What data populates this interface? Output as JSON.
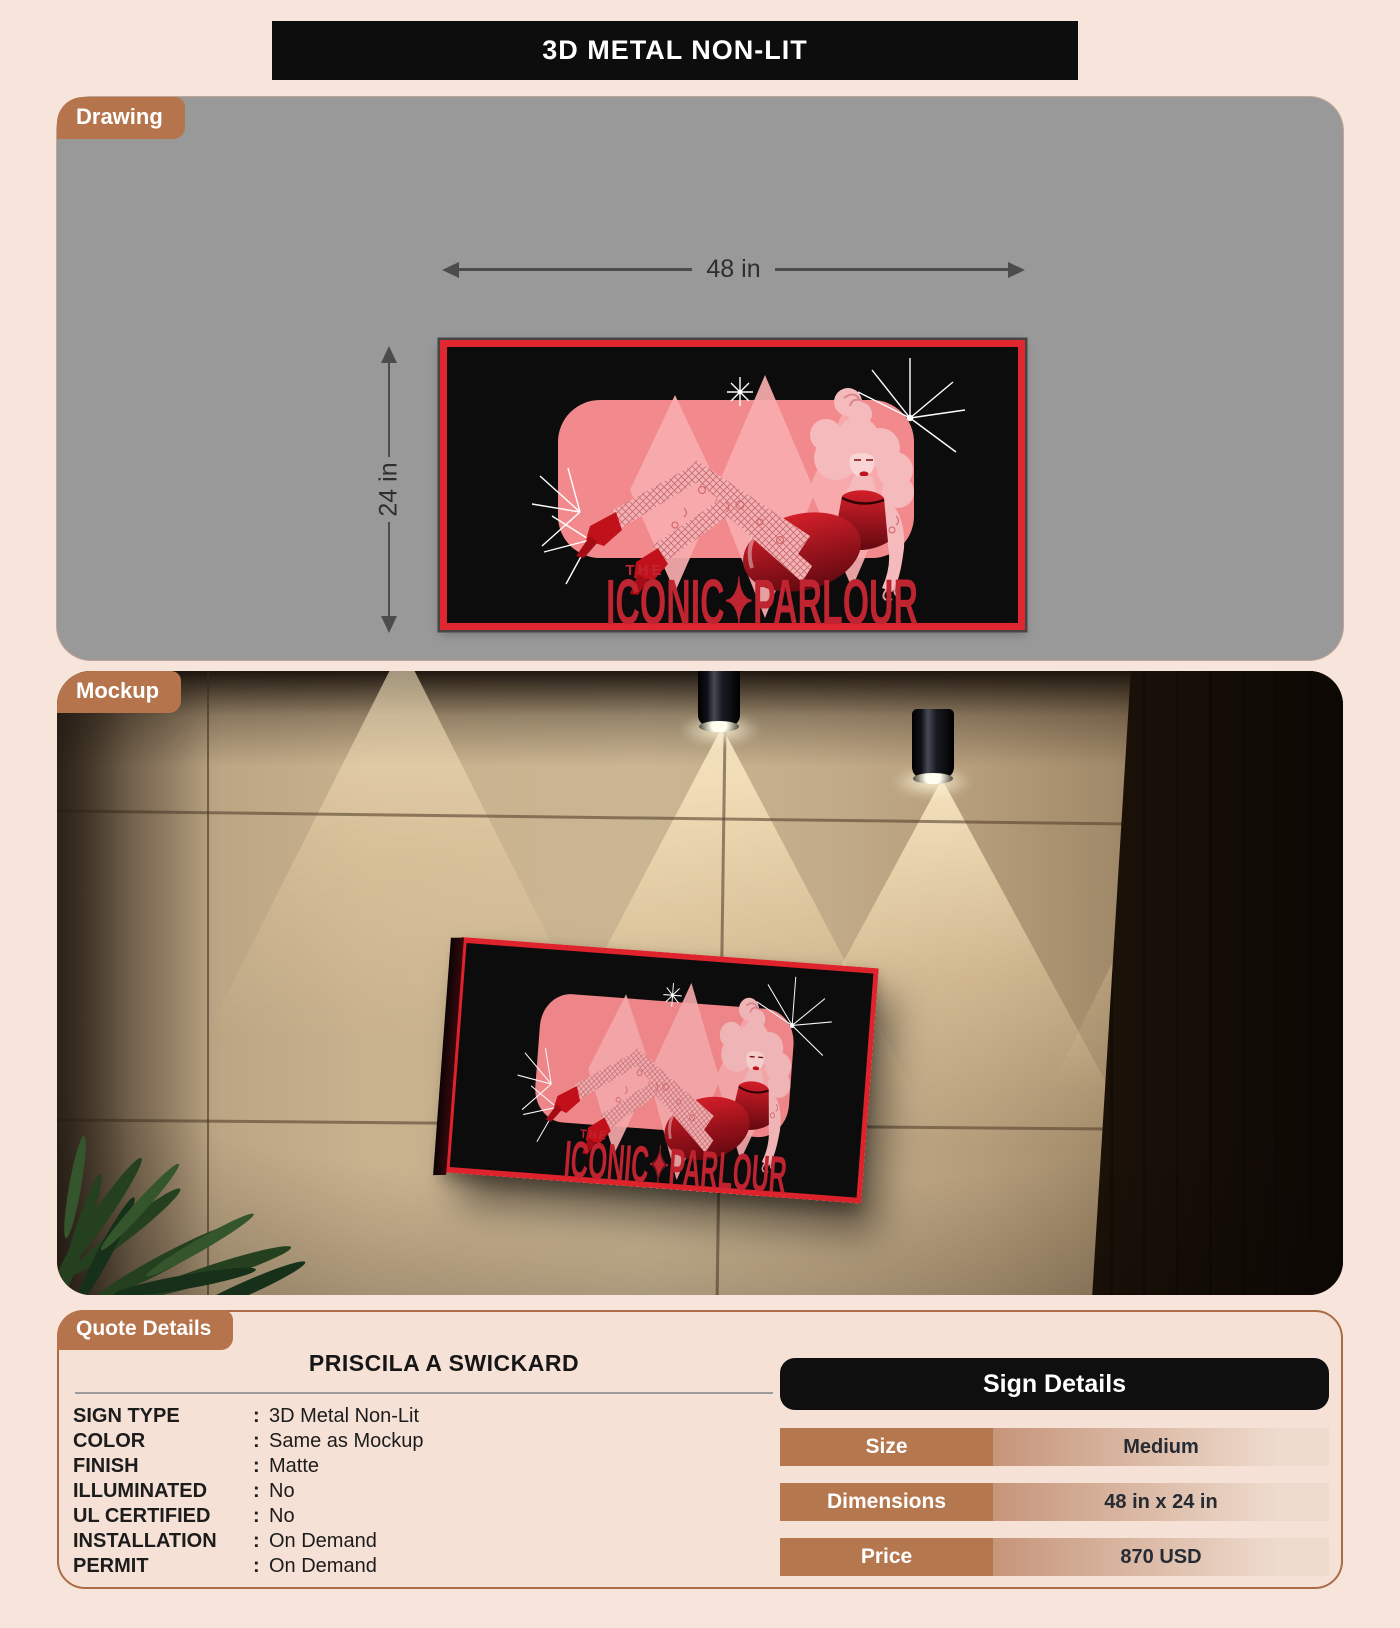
{
  "page": {
    "title": "3D METAL NON-LIT"
  },
  "drawing": {
    "tag": "Drawing",
    "width_label": "48 in",
    "height_label": "24 in"
  },
  "sign_art": {
    "the": "THE",
    "name": "ICONIC✦PARLOUR"
  },
  "mockup": {
    "tag": "Mockup"
  },
  "quote": {
    "tag": "Quote Details",
    "customer": "PRISCILA A SWICKARD",
    "colon": ":",
    "fields": [
      {
        "label": "SIGN TYPE",
        "value": "3D Metal Non-Lit"
      },
      {
        "label": "COLOR",
        "value": "Same as Mockup"
      },
      {
        "label": "FINISH",
        "value": "Matte"
      },
      {
        "label": "ILLUMINATED",
        "value": "No"
      },
      {
        "label": "UL CERTIFIED",
        "value": "No"
      },
      {
        "label": "INSTALLATION",
        "value": "On Demand"
      },
      {
        "label": "PERMIT",
        "value": "On Demand"
      }
    ]
  },
  "sign_details": {
    "header": "Sign Details",
    "rows": [
      {
        "label": "Size",
        "value": "Medium"
      },
      {
        "label": "Dimensions",
        "value": "48 in x 24 in"
      },
      {
        "label": "Price",
        "value": "870 USD"
      }
    ]
  },
  "colors": {
    "page_bg": "#f7e4da",
    "accent_brown": "#b5744c",
    "panel_gray": "#9a999a",
    "title_bar_bg": "#0d0d0d",
    "sign_frame_red": "#e0262f",
    "art_text_red": "#bf2531",
    "table_label_bg": "#b5774e"
  }
}
